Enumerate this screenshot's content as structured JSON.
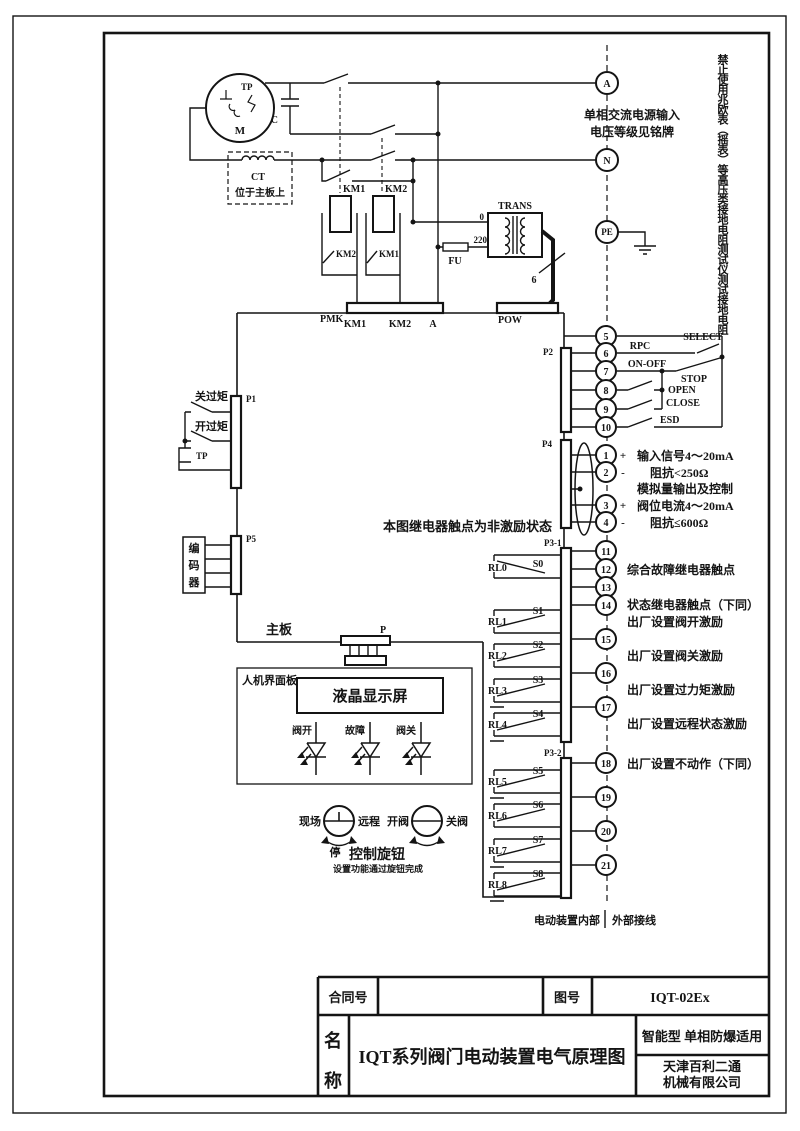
{
  "power": {
    "a": "A",
    "n": "N",
    "pe": "PE",
    "note1": "单相交流电源输入",
    "note2": "电压等级见铭牌",
    "margin_warning": "禁止使用兆欧表（摇表）等高压类接地电阻测试仪测试接地电阻"
  },
  "motor": {
    "m": "M",
    "tp": "TP",
    "cap": "C"
  },
  "ct": {
    "label": "CT",
    "note": "位于主板上"
  },
  "km": {
    "km1": "KM1",
    "km2": "KM2",
    "aux_km2": "KM2",
    "aux_km1": "KM1"
  },
  "pmk": {
    "label": "PMK",
    "pins": [
      "KM1",
      "KM2",
      "A"
    ]
  },
  "pow": {
    "label": "POW"
  },
  "trans": {
    "label": "TRANS",
    "tap0": "0",
    "tap220": "220",
    "fu": "FU",
    "sec": "6"
  },
  "p2": {
    "label": "P2",
    "terminals": [
      "5",
      "6",
      "7",
      "8",
      "9",
      "10"
    ],
    "rpc": "RPC",
    "select": "SELECT",
    "onoff": "ON-OFF",
    "stop": "STOP",
    "open": "OPEN",
    "close": "CLOSE",
    "esd": "ESD"
  },
  "p4": {
    "label": "P4",
    "terminals": [
      "1",
      "2",
      "3",
      "4"
    ],
    "plus1": "+",
    "minus1": "-",
    "plus2": "+",
    "minus2": "-",
    "row1": "输入信号4～20mA",
    "row2": "阻抗<250Ω",
    "row3": "模拟量输出及控制",
    "row4": "阀位电流4～20mA",
    "row5": "阻抗≤600Ω"
  },
  "p31": {
    "label": "P3-1",
    "terminals": [
      "11",
      "12",
      "13",
      "14",
      "15",
      "16",
      "17"
    ]
  },
  "p32": {
    "label": "P3-2",
    "terminals": [
      "18",
      "19",
      "20",
      "21"
    ]
  },
  "notes": {
    "n1": "综合故障继电器触点",
    "n2": "状态继电器触点（下同）",
    "n3": "出厂设置阀开激励",
    "n4": "出厂设置阀关激励",
    "n5": "出厂设置过力矩激励",
    "n6": "出厂设置远程状态激励",
    "n7": "出厂设置不动作（下同）"
  },
  "relays": [
    {
      "name": "RL0",
      "s": "S0"
    },
    {
      "name": "RL1",
      "s": "S1"
    },
    {
      "name": "RL2",
      "s": "S2"
    },
    {
      "name": "RL3",
      "s": "S3"
    },
    {
      "name": "RL4",
      "s": "S4"
    },
    {
      "name": "RL5",
      "s": "S5"
    },
    {
      "name": "RL6",
      "s": "S6"
    },
    {
      "name": "RL7",
      "s": "S7"
    },
    {
      "name": "RL8",
      "s": "S8"
    }
  ],
  "left": {
    "p1": "P1",
    "close_ot": "关过矩",
    "open_ot": "开过矩",
    "tp": "TP",
    "p5": "P5",
    "encoder": [
      "编",
      "码",
      "器"
    ]
  },
  "board": {
    "label": "主板",
    "p": "P",
    "note": "本图继电器触点为非激励状态"
  },
  "hmi": {
    "label": "人机界面板",
    "lcd": "液晶显示屏",
    "led1": "阀开",
    "led2": "故障",
    "led3": "阀关",
    "k1l": "现场",
    "k1r": "远程",
    "k1b": "停",
    "k2l": "开阀",
    "k2r": "关阀",
    "knob": "控制旋钮",
    "knob_note": "设置功能通过旋钮完成"
  },
  "boundary": {
    "inside": "电动装置内部",
    "outside": "外部接线"
  },
  "tb": {
    "contract": "合同号",
    "contract_value": "",
    "fig": "图号",
    "figno": "IQT-02Ex",
    "n1": "名",
    "n2": "称",
    "title": "IQT系列阀门电动装置电气原理图",
    "type": "智能型  单相防爆适用",
    "co1": "天津百利二通",
    "co2": "机械有限公司"
  }
}
